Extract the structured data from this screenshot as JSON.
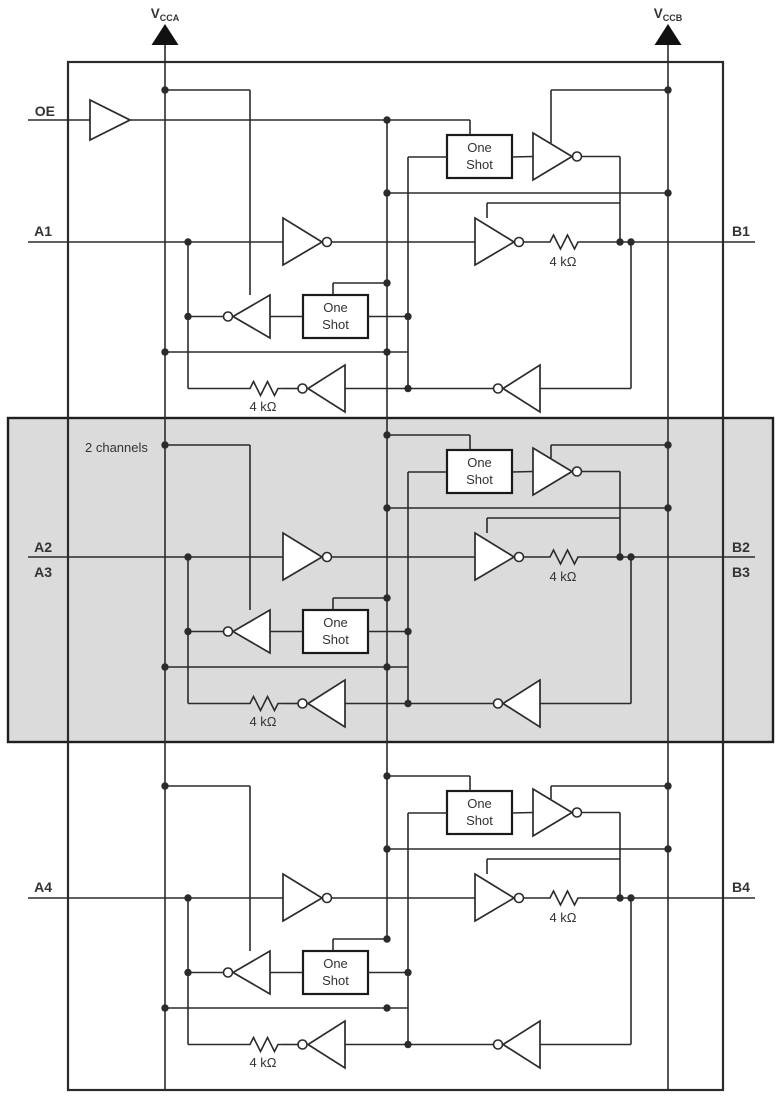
{
  "diagram": {
    "power": {
      "vcca": {
        "base": "V",
        "sub": "CCA"
      },
      "vccb": {
        "base": "V",
        "sub": "CCB"
      }
    },
    "enable": {
      "label": "OE"
    },
    "region_note": "2 channels",
    "one_shot": {
      "line1": "One",
      "line2": "Shot"
    },
    "resistor_label": "4 kΩ",
    "channels": [
      {
        "a_labels": [
          "A1"
        ],
        "b_labels": [
          "B1"
        ]
      },
      {
        "a_labels": [
          "A2",
          "A3"
        ],
        "b_labels": [
          "B2",
          "B3"
        ]
      },
      {
        "a_labels": [
          "A4"
        ],
        "b_labels": [
          "B4"
        ]
      }
    ],
    "colors": {
      "line": "#2b2b2b",
      "shade": "#dbdbdb",
      "box_fill": "#ffffff",
      "text": "#333333"
    }
  }
}
